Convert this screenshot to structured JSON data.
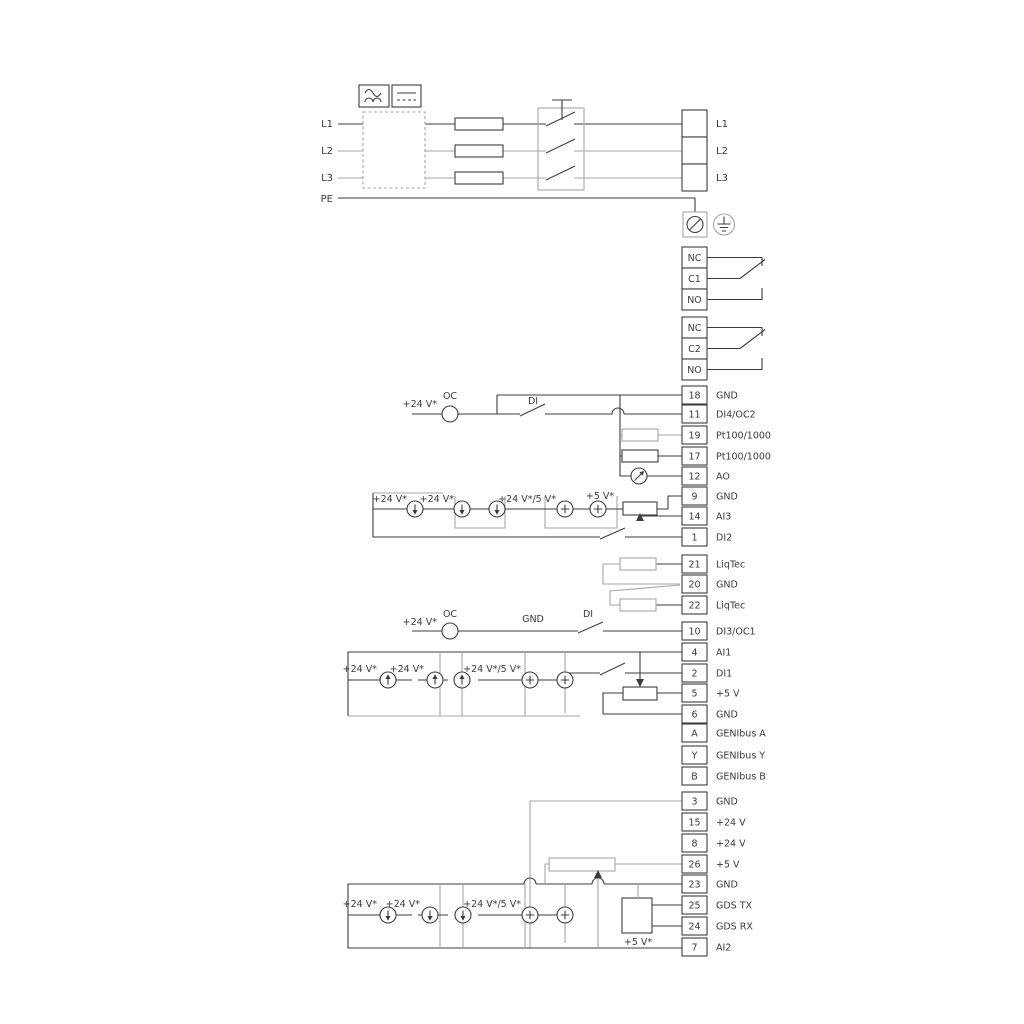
{
  "power": {
    "left_labels": [
      "L1",
      "L2",
      "L3",
      "PE"
    ],
    "right_labels": [
      "L1",
      "L2",
      "L3"
    ]
  },
  "relays": {
    "relay1": [
      "NC",
      "C1",
      "NO"
    ],
    "relay2": [
      "NC",
      "C2",
      "NO"
    ]
  },
  "terminal_groups": {
    "io1": [
      {
        "num": "18",
        "label": "GND"
      },
      {
        "num": "11",
        "label": "DI4/OC2"
      },
      {
        "num": "19",
        "label": "Pt100/1000"
      },
      {
        "num": "17",
        "label": "Pt100/1000"
      },
      {
        "num": "12",
        "label": "AO"
      },
      {
        "num": "9",
        "label": "GND"
      },
      {
        "num": "14",
        "label": "AI3"
      },
      {
        "num": "1",
        "label": "DI2"
      }
    ],
    "liqtec": [
      {
        "num": "21",
        "label": "LiqTec"
      },
      {
        "num": "20",
        "label": "GND"
      },
      {
        "num": "22",
        "label": "LiqTec"
      }
    ],
    "io2": [
      {
        "num": "10",
        "label": "DI3/OC1"
      },
      {
        "num": "4",
        "label": "AI1"
      },
      {
        "num": "2",
        "label": "DI1"
      },
      {
        "num": "5",
        "label": "+5 V"
      },
      {
        "num": "6",
        "label": "GND"
      },
      {
        "num": "A",
        "label": "GENIbus A"
      },
      {
        "num": "Y",
        "label": "GENIbus Y"
      },
      {
        "num": "B",
        "label": "GENIbus B"
      }
    ],
    "supply": [
      {
        "num": "3",
        "label": "GND"
      },
      {
        "num": "15",
        "label": "+24 V"
      },
      {
        "num": "8",
        "label": "+24 V"
      },
      {
        "num": "26",
        "label": "+5 V"
      },
      {
        "num": "23",
        "label": "GND"
      },
      {
        "num": "25",
        "label": "GDS TX"
      },
      {
        "num": "24",
        "label": "GDS RX"
      },
      {
        "num": "7",
        "label": "AI2"
      }
    ]
  },
  "annotations": [
    {
      "text": "+24 V*"
    },
    {
      "text": "OC"
    },
    {
      "text": "DI"
    },
    {
      "text": "+24 V*"
    },
    {
      "text": "+24 V*"
    },
    {
      "text": "+24 V*/5 V*"
    },
    {
      "text": "+5 V*"
    },
    {
      "text": "+24 V*"
    },
    {
      "text": "OC"
    },
    {
      "text": "GND"
    },
    {
      "text": "DI"
    },
    {
      "text": "+24 V*"
    },
    {
      "text": "+24 V*"
    },
    {
      "text": "+24 V*/5 V*"
    },
    {
      "text": "+24 V*"
    },
    {
      "text": "+24 V*"
    },
    {
      "text": "+24 V*/5 V*"
    },
    {
      "text": "+5 V*"
    }
  ],
  "colors": {
    "line": "#3c3c3c",
    "line_gray": "#a6a6a6",
    "text": "#3a3a3a",
    "background": "#ffffff"
  }
}
